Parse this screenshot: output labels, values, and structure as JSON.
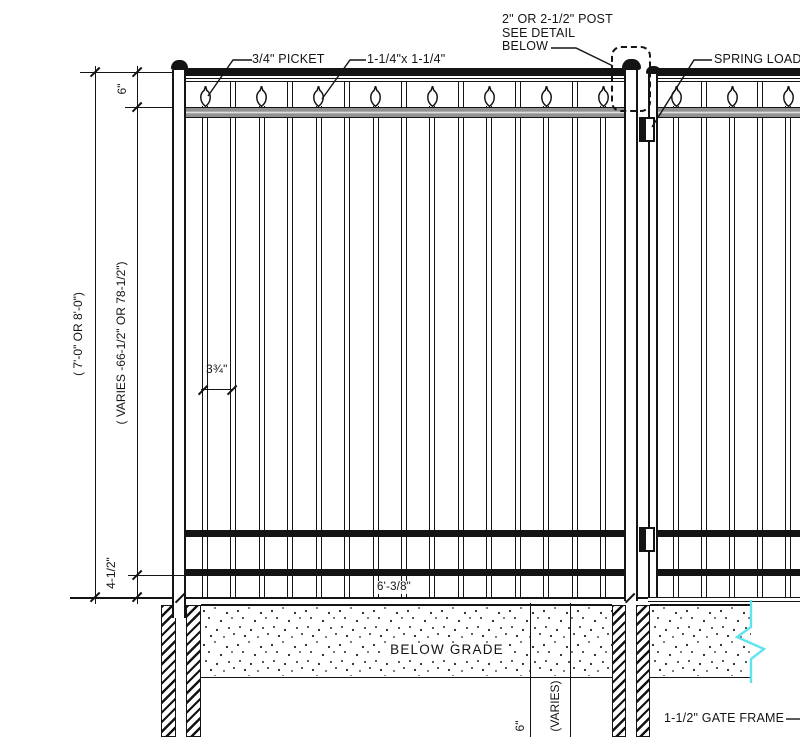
{
  "callouts": {
    "picket": "3/4\" PICKET",
    "rail": "1-1/4\"x 1-1/4\"",
    "post_note_line1": "2\" OR 2-1/2\" POST",
    "post_note_line2": "SEE DETAIL",
    "post_note_line3": "BELOW",
    "spring_hinge": "SPRING LOAD",
    "gate_frame": "1-1/2\" GATE FRAME",
    "below_grade": "BELOW GRADE"
  },
  "dimensions": {
    "overall_height": "( 7'-0\" OR 8'-0\")",
    "spear_offset": "6\"",
    "picket_height": "( VARIES -66-1/2\" OR 78-1/2\")",
    "bottom_clearance": "4-1/2\"",
    "panel_width": "6'-3/8\"",
    "picket_spacing": "3¾\"",
    "footing_top_depth": "6\"",
    "footing_depth": "(VARIES)"
  },
  "colors": {
    "line": "#141414",
    "rail_gray": "#919191",
    "break_line": "#5fe3ee"
  }
}
